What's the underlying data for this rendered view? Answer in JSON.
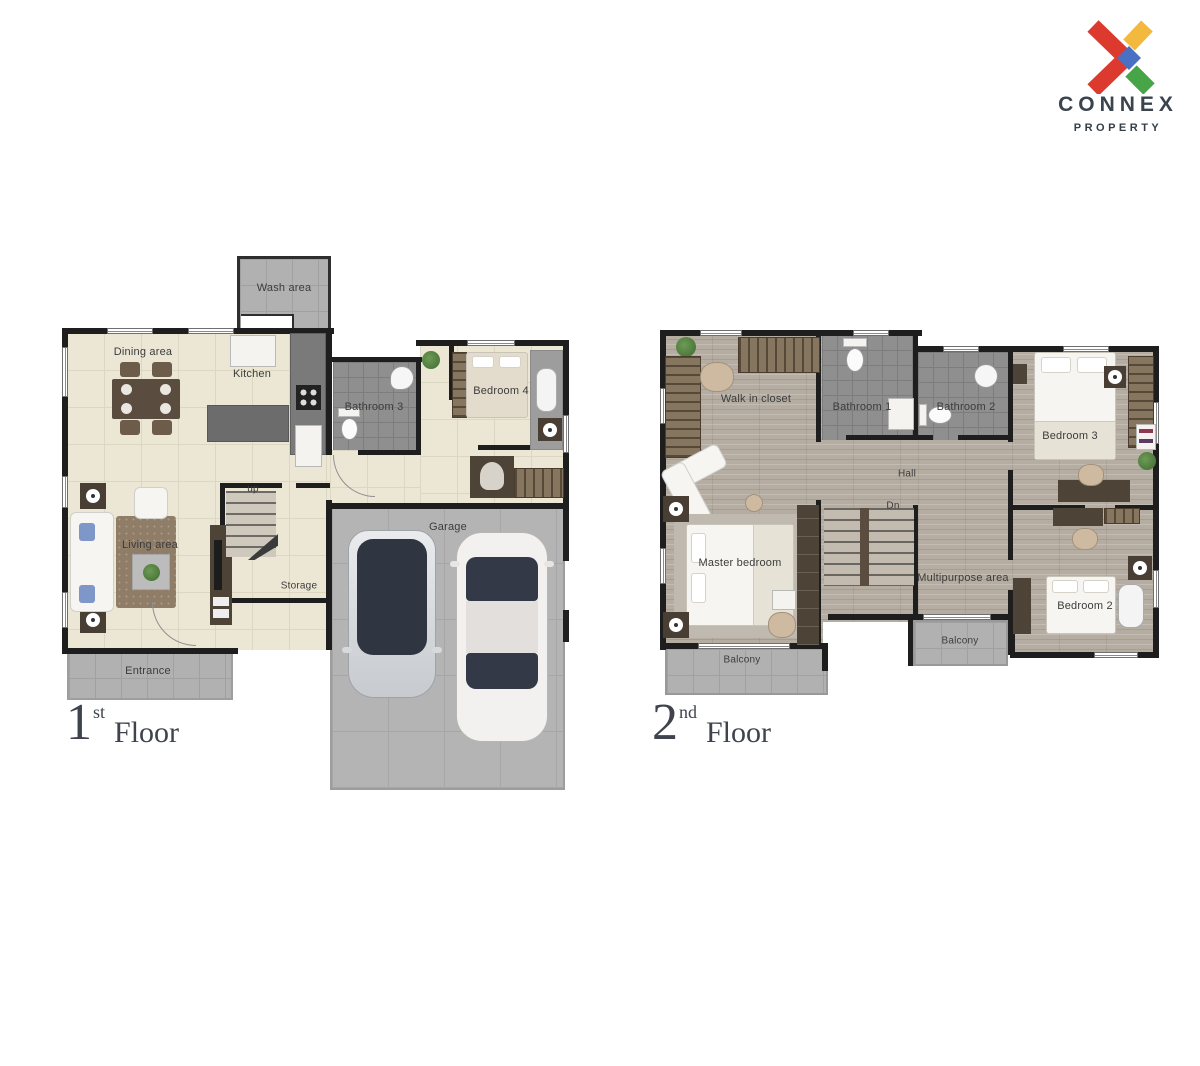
{
  "logo": {
    "brand": "CONNEX",
    "subtitle": "PROPERTY",
    "colors": {
      "red": "#dc3a2e",
      "yellow": "#f2b93e",
      "green": "#47a447",
      "blue": "#4a70c4",
      "text": "#39444e"
    }
  },
  "floor1": {
    "title": {
      "number": "1",
      "ordinal": "st",
      "word": "Floor"
    },
    "labels": {
      "wash_area": "Wash area",
      "dining_area": "Dining area",
      "kitchen": "Kitchen",
      "bathroom3": "Bathroom 3",
      "bedroom4": "Bedroom 4",
      "living_area": "Living area",
      "up": "up",
      "storage": "Storage",
      "garage": "Garage",
      "entrance": "Entrance"
    }
  },
  "floor2": {
    "title": {
      "number": "2",
      "ordinal": "nd",
      "word": "Floor"
    },
    "labels": {
      "walk_in_closet": "Walk in closet",
      "bathroom1": "Bathroom 1",
      "bathroom2": "Bathroom 2",
      "bedroom3": "Bedroom 3",
      "hall": "Hall",
      "dn": "Dn",
      "master_bedroom": "Master bedroom",
      "multipurpose_area": "Multipurpose area",
      "bedroom2": "Bedroom 2",
      "balcony_master": "Balcony",
      "balcony_center": "Balcony"
    }
  }
}
